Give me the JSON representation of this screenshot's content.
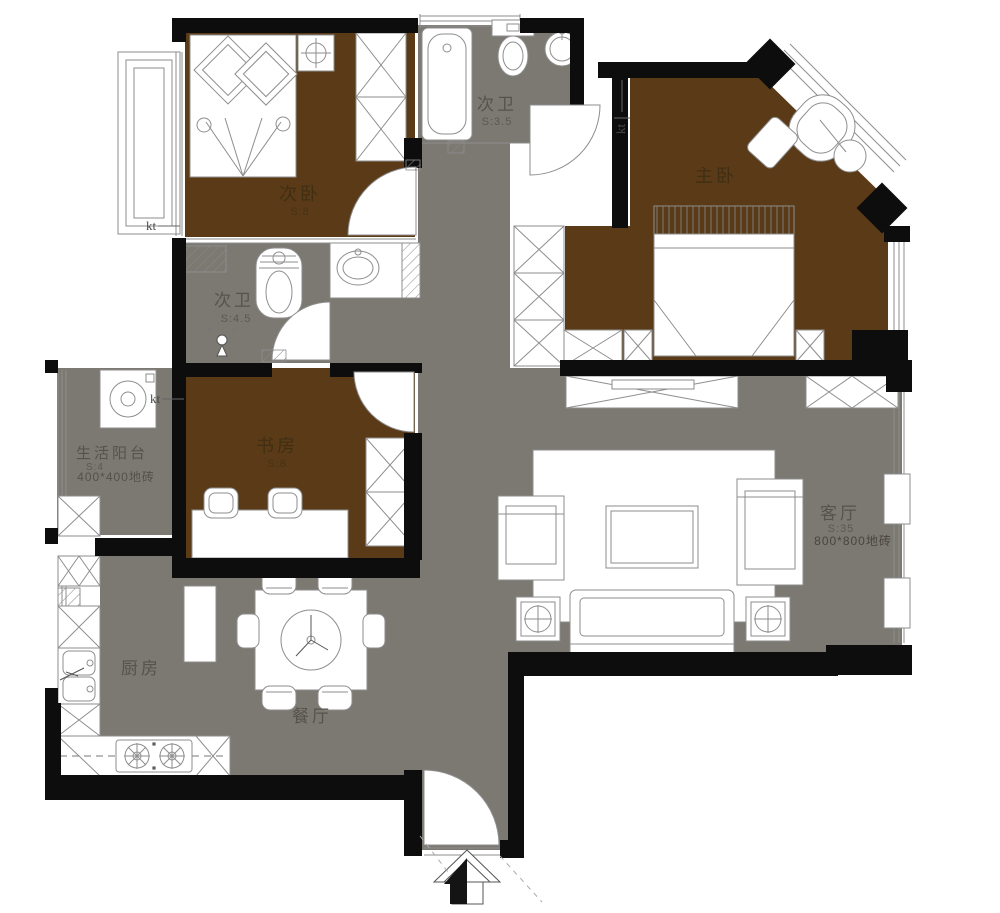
{
  "colors": {
    "wall": "#0d0d0d",
    "bedroom_floor": "#5a3a17",
    "tile_floor": "#7c7872",
    "fixture_line": "#8e8e8e",
    "background": "#ffffff"
  },
  "rooms": [
    {
      "id": "secondary-bedroom",
      "name": "次卧",
      "area": "S:8"
    },
    {
      "id": "secondary-bathroom-upper",
      "name": "次卫",
      "area": "S:3.5"
    },
    {
      "id": "master-bedroom",
      "name": "主卧"
    },
    {
      "id": "secondary-bathroom-lower",
      "name": "次卫",
      "area": "S:4.5"
    },
    {
      "id": "service-balcony",
      "name": "生活阳台",
      "area": "S:4",
      "floor_note": "400*400地砖"
    },
    {
      "id": "study",
      "name": "书房",
      "area": "S:8"
    },
    {
      "id": "living-room",
      "name": "客厅",
      "area": "S:35",
      "floor_note": "800*800地砖"
    },
    {
      "id": "kitchen",
      "name": "厨房"
    },
    {
      "id": "dining-room",
      "name": "餐厅"
    }
  ],
  "annotations": {
    "kt_left_upper": "kt",
    "kt_left_lower": "kt",
    "kt_top": "kt"
  }
}
